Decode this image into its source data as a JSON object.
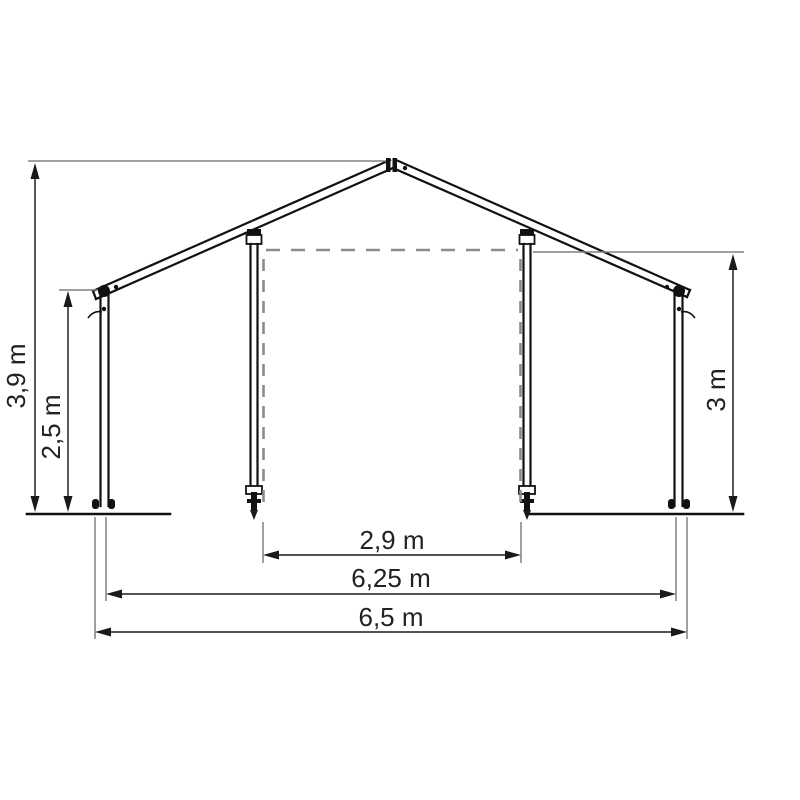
{
  "diagram": {
    "subject": "tent-frame-front-elevation",
    "background_color": "#ffffff",
    "frame_color": "#111111",
    "dashed_outline_color": "#8c8c8c",
    "dimension_line_color": "#3c3c3c",
    "text_color": "#222222",
    "units": "m",
    "dimensions": {
      "peak_height": {
        "label": "3,9 m",
        "value_m": 3.9
      },
      "eave_height": {
        "label": "2,5 m",
        "value_m": 2.5
      },
      "entrance_height": {
        "label": "3 m",
        "value_m": 3
      },
      "entrance_width": {
        "label": "2,9 m",
        "value_m": 2.9
      },
      "post_span": {
        "label": "6,25 m",
        "value_m": 6.25
      },
      "total_width": {
        "label": "6,5 m",
        "value_m": 6.5
      }
    }
  }
}
